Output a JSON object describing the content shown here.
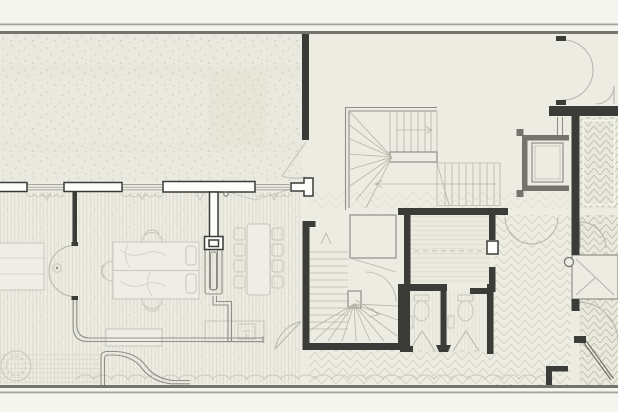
{
  "meta": {
    "description": "architectural floor plan drawing, no visible text labels",
    "plan_elements": [
      "garden-terrace-stippled",
      "window-wall-with-curtains",
      "bedroom-left-desk",
      "bedroom-double-bed",
      "pocket-door",
      "curved-glass-partition",
      "dining-table-with-chairs",
      "winder-stair-upper",
      "winder-stair-lower",
      "elevator-shaft",
      "study-room-hatched",
      "twin-wc-stalls",
      "herringbone-hallway",
      "closet-with-diagonal",
      "double-entry-doors",
      "entry-door-diagonal-leaf",
      "wavy-floor-edge"
    ]
  },
  "colors": {
    "paper": "#f5f5ef",
    "floor": "#edece3",
    "floorLight": "#efeee6",
    "garden": "#eae9df",
    "gardenBed": "#e7e6d9",
    "wallDark": "#3b3b37",
    "wallMedium": "#74746d",
    "wallLight": "#8f8f88",
    "exteriorLine": "#a3a39b",
    "furniture": "#c6c6bb",
    "tread": "#b6b6ab",
    "doorArc": "#b5b5ac",
    "deco": "#c9c9bf",
    "hatch": "#d9d9cc",
    "hatchH": "#cfcec0",
    "hatchHD": "#bcbbaa",
    "white": "#fdfdfb"
  }
}
